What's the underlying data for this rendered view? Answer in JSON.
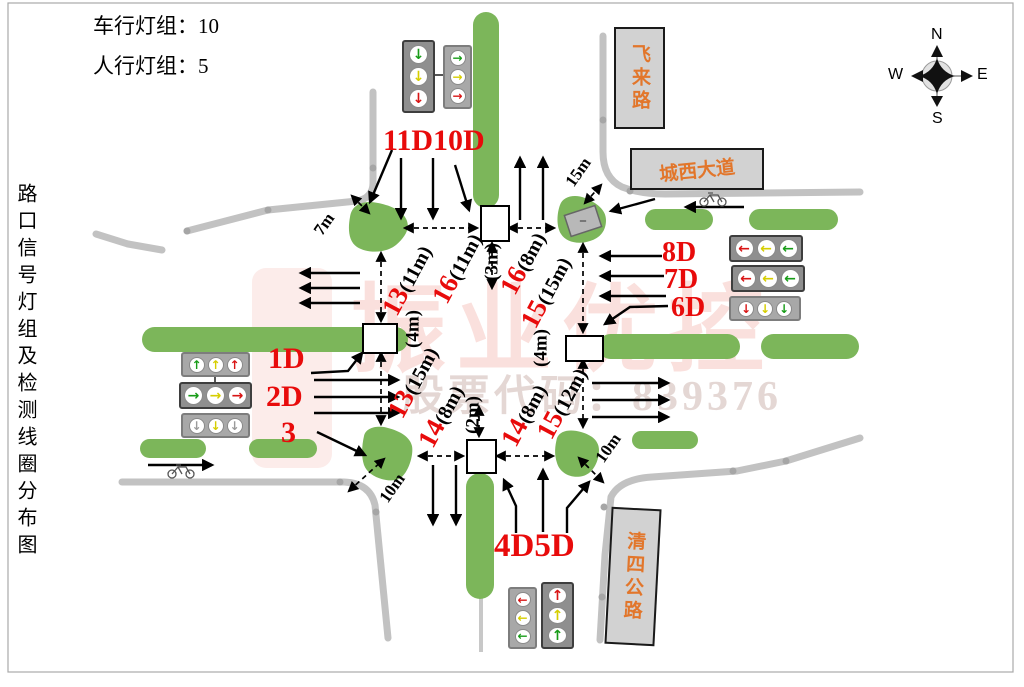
{
  "header": {
    "line1": "车行灯组：10",
    "line2": "人行灯组：5"
  },
  "side_title": "路口信号灯组及检测线圈分布图",
  "compass": {
    "n": "N",
    "s": "S",
    "w": "W",
    "e": "E"
  },
  "road_signs": {
    "feilai": "飞来路",
    "chengxi": "城西大道",
    "qingsi": "清四公路"
  },
  "group_labels": {
    "north": "11D10D",
    "west1": "1D",
    "west2": "2D",
    "west3": "3",
    "east1": "8D",
    "east2": "7D",
    "east3": "6D",
    "south": "4D5D"
  },
  "measurements": {
    "nw_island": "7m",
    "ne_island": "15m",
    "sw_island": "10m",
    "se_island": "10m",
    "north_box_gap": "(3m)",
    "west_box_gap": "(4m)",
    "east_box_gap": "(4m)",
    "south_box_gap": "(2m)",
    "loop13_upper": {
      "num": "13",
      "dist": "(11m)"
    },
    "loop16_left": {
      "num": "16",
      "dist": "(11m)"
    },
    "loop16_right": {
      "num": "16",
      "dist": "(8m)"
    },
    "loop15_upper": {
      "num": "15",
      "dist": "(15m)"
    },
    "loop13_lower": {
      "num": "13",
      "dist": "(15m)"
    },
    "loop14_left": {
      "num": "14",
      "dist": "(8m)"
    },
    "loop14_right": {
      "num": "14",
      "dist": "(8m)"
    },
    "loop15_lower": {
      "num": "15",
      "dist": "(12m)"
    }
  },
  "watermark": {
    "brand": "振业优控",
    "stock": "股票代码：839376"
  },
  "icons": {
    "up": "↑",
    "down": "↓",
    "left": "←",
    "right": "→"
  },
  "colors": {
    "label_red": "#e80b0b",
    "median_green": "#7cb65a",
    "road_gray": "#c2c2c2",
    "sign_orange": "#e2762b"
  }
}
